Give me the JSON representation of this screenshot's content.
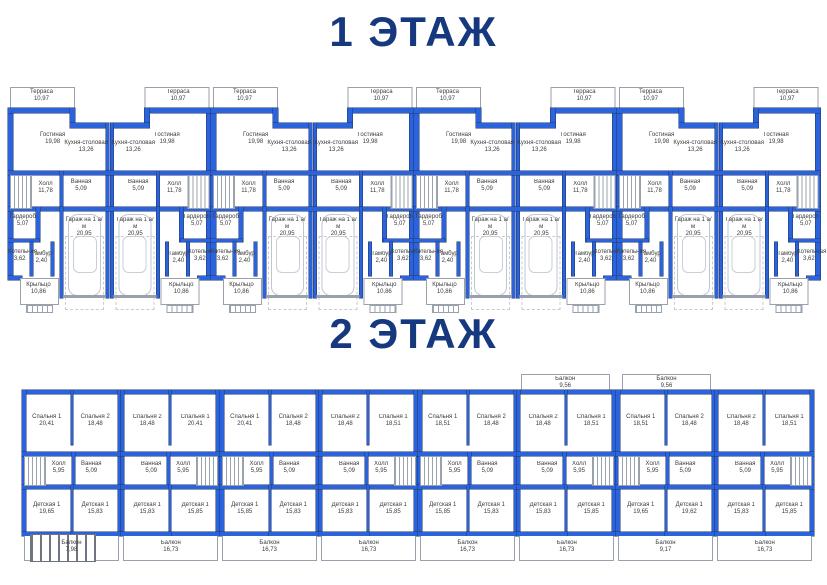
{
  "colors": {
    "wall": "#2b63dd",
    "title_navy": "#16387e",
    "thin_line": "#98a1ac",
    "label_text": "#3c3c3c"
  },
  "floor1": {
    "title": "1 ЭТАЖ",
    "rooms": {
      "terrace": {
        "name": "Терраса",
        "area": "10,97"
      },
      "living": {
        "name": "Гостиная",
        "area": "19,98"
      },
      "kitchen": {
        "name": "Кухня-столовая",
        "area": "13,26"
      },
      "hall": {
        "name": "Холл",
        "area": "11,78"
      },
      "bath": {
        "name": "Ванная",
        "area": "5,09"
      },
      "wardrobe": {
        "name": "Гардероб",
        "area": "5,07"
      },
      "boiler": {
        "name": "Котельная",
        "area": "3,62"
      },
      "tambour": {
        "name": "Тамбур",
        "area": "2,40"
      },
      "garage": {
        "name": "Гараж на 1 а/м",
        "area": "20,95"
      },
      "porch": {
        "name": "Крыльцо",
        "area": "10,86"
      }
    },
    "units": [
      {
        "mirror": false
      },
      {
        "mirror": true
      },
      {
        "mirror": false
      },
      {
        "mirror": true
      },
      {
        "mirror": false
      },
      {
        "mirror": true
      },
      {
        "mirror": false
      },
      {
        "mirror": true
      }
    ]
  },
  "floor2": {
    "title": "2 ЭТАЖ",
    "labels": {
      "bed1_name": "Спальня 1",
      "bed2_name": "Спальня 2",
      "hall_name": "Холл",
      "hall_area": "5,95",
      "bath_name": "Ванная",
      "bath_area": "5,09",
      "kid_name": "Детская 1",
      "balcony_name": "Балкон"
    },
    "units": [
      {
        "mirror": false,
        "deep": "left",
        "bed1": "20,41",
        "bed2": "18,48",
        "kid1": "19,65",
        "kid2": "15,83",
        "balcony_bottom": "7,98"
      },
      {
        "mirror": true,
        "deep": "",
        "bed1": "20,41",
        "bed2": "18,48",
        "kid1": "15,85",
        "kid2": "15,83",
        "balcony_bottom": "16,73"
      },
      {
        "mirror": false,
        "deep": "",
        "bed1": "20,41",
        "bed2": "18,48",
        "kid1": "15,85",
        "kid2": "15,83",
        "balcony_bottom": "16,73"
      },
      {
        "mirror": true,
        "deep": "",
        "bed1": "18,51",
        "bed2": "18,48",
        "kid1": "15,85",
        "kid2": "15,83",
        "balcony_bottom": "16,73"
      },
      {
        "mirror": false,
        "deep": "",
        "bed1": "18,51",
        "bed2": "18,48",
        "kid1": "15,85",
        "kid2": "15,83",
        "balcony_bottom": "16,73"
      },
      {
        "mirror": true,
        "deep": "",
        "bed1": "18,51",
        "bed2": "18,48",
        "kid1": "15,85",
        "kid2": "15,83",
        "balcony_bottom": "16,73",
        "balcony_top": "9,56"
      },
      {
        "mirror": false,
        "deep": "both",
        "bed1": "18,51",
        "bed2": "18,48",
        "kid1": "19,65",
        "kid2": "19,62",
        "balcony_bottom": "9,17",
        "balcony_top": "9,56"
      },
      {
        "mirror": true,
        "deep": "",
        "bed1": "18,51",
        "bed2": "18,48",
        "kid1": "15,85",
        "kid2": "15,83",
        "balcony_bottom": "16,73"
      }
    ]
  }
}
